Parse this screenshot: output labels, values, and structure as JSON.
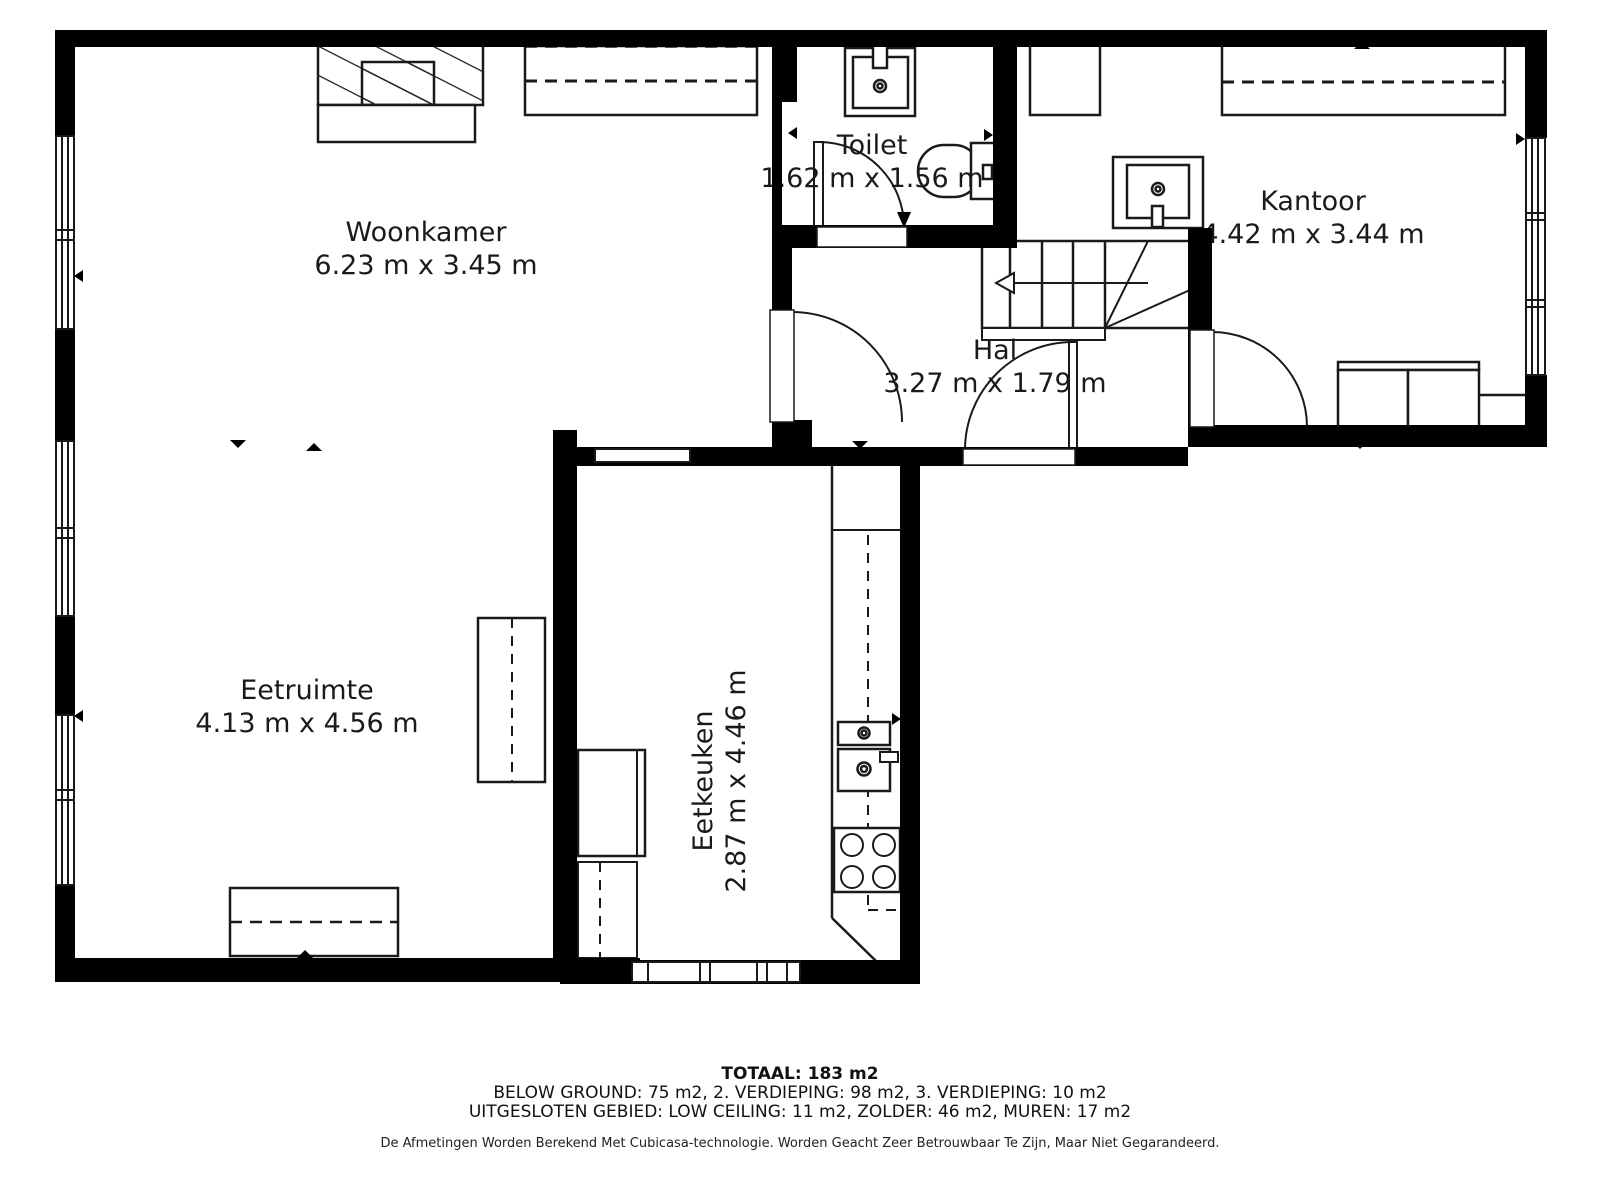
{
  "rooms": {
    "woonkamer": {
      "name": "Woonkamer",
      "dims": "6.23 m x 3.45 m"
    },
    "toilet": {
      "name": "Toilet",
      "dims": "1.62 m x 1.56 m"
    },
    "kantoor": {
      "name": "Kantoor",
      "dims": "4.42 m x 3.44 m"
    },
    "hal": {
      "name": "Hal",
      "dims": "3.27 m x 1.79 m"
    },
    "eetruimte": {
      "name": "Eetruimte",
      "dims": "4.13 m x 4.56 m"
    },
    "eetkeuken": {
      "name": "Eetkeuken",
      "dims": "2.87 m x 4.46 m"
    }
  },
  "footer": {
    "total": "TOTAAL: 183 m2",
    "line1": "BELOW GROUND: 75 m2, 2. VERDIEPING: 98 m2, 3. VERDIEPING: 10 m2",
    "line2": "UITGESLOTEN GEBIED: LOW CEILING: 11 m2, ZOLDER: 46 m2, MUREN: 17 m2",
    "disclaimer": "De Afmetingen Worden Berekend Met Cubicasa-technologie. Worden Geacht Zeer Betrouwbaar Te Zijn, Maar Niet Gegarandeerd."
  },
  "colors": {
    "wall": "#000000",
    "line": "#1a1a1a",
    "background": "#ffffff"
  }
}
